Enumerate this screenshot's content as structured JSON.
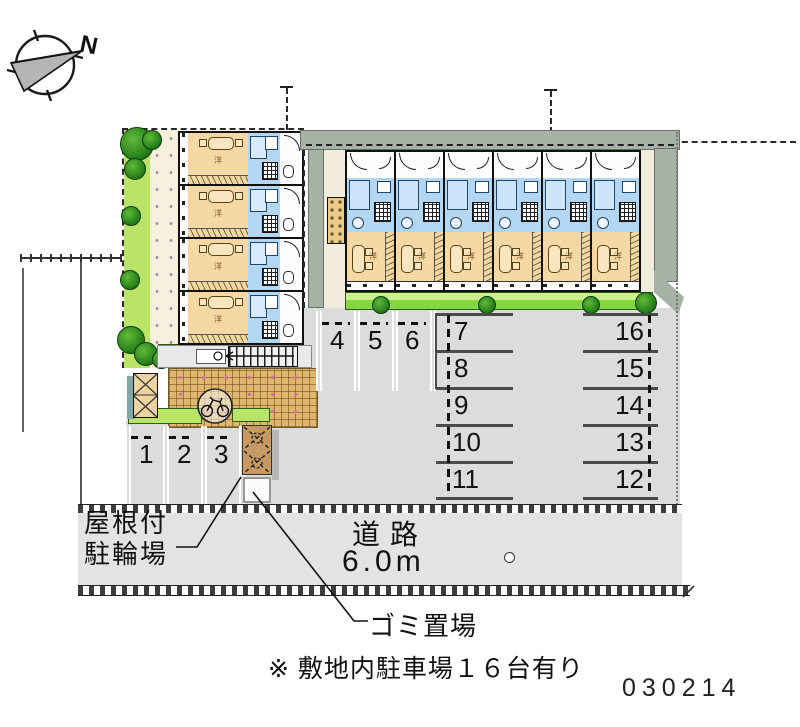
{
  "page": {
    "drawing_number": "030214"
  },
  "compass": {
    "label": "N"
  },
  "labels": {
    "bike_shelter_line1": "屋根付",
    "bike_shelter_line2": "駐輪場",
    "road_name": "道路",
    "road_width": "6.0m",
    "garbage": "ゴミ置場",
    "note": "※ 敷地内駐車場１６台有り",
    "room": "洋"
  },
  "parking": {
    "top_row": [
      "4",
      "5",
      "6"
    ],
    "bottom_row": [
      "1",
      "2",
      "3"
    ],
    "left_column": [
      "7",
      "8",
      "9",
      "10",
      "11"
    ],
    "right_column": [
      "16",
      "15",
      "14",
      "13",
      "12"
    ]
  },
  "colors": {
    "room_tan": "#f6d8a4",
    "wet_blue": "#b3d7f2",
    "hedge_green": "#84d83e",
    "walkway_sage": "#a6b2a6",
    "brick_tan": "#e0b66e",
    "shelter_brown": "#c79a63",
    "parking_gray": "#dcdcdc",
    "road_gray": "#e3e3e3"
  }
}
